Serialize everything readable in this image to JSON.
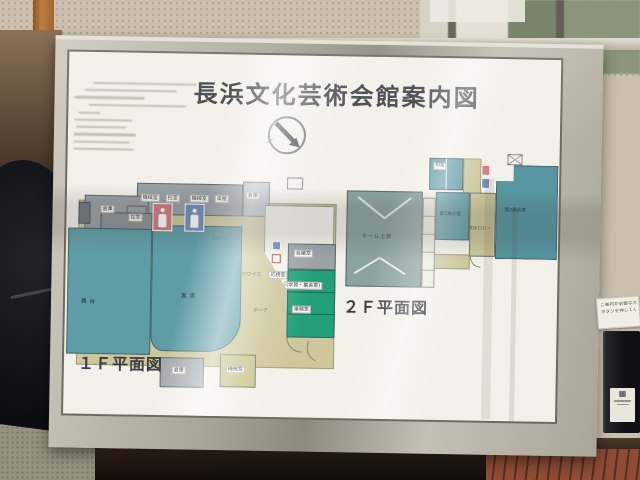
{
  "photo": {
    "board": {
      "title": "長浜文化芸術会館案内図",
      "floor1": {
        "caption": "１Ｆ平面図",
        "rooms": {
          "stage": "舞台",
          "audience": "客席",
          "storage_left": "倉庫",
          "anteroom_left": "控室",
          "machine_a": "機械室",
          "anteroom_top": "控室",
          "machine_b": "機械室",
          "dressing": "楽屋",
          "storage_top": "倉庫",
          "meeting": "会議室",
          "reception": "応接室",
          "study_assembly": "(学習・集会室)",
          "office": "事務室",
          "lobby": "ロビー",
          "foyer": "ホワイエ",
          "porch": "ポーチ",
          "storage_bottom": "倉庫",
          "hvac": "機械室"
        }
      },
      "floor2": {
        "caption": "２Ｆ平面図",
        "rooms": {
          "hall_upper": "ホール上部",
          "exhibit1": "第1展示室",
          "exhibit2": "第2展示室",
          "exhibit_lobby": "展示ロビー",
          "japanese_room": "和室"
        }
      }
    },
    "intercom": {
      "sign_line1": "ご案内が必要な方は",
      "sign_line2": "ボタンを押してください"
    },
    "colors": {
      "teal_room": "#5f9da6",
      "beige_circulation": "#cdc79b",
      "green_office": "#23a079",
      "gray_service": "#98a0a6",
      "toilet_female": "#cf7b82",
      "toilet_male": "#7391bd",
      "metal_frame": "#b3aea3"
    }
  }
}
